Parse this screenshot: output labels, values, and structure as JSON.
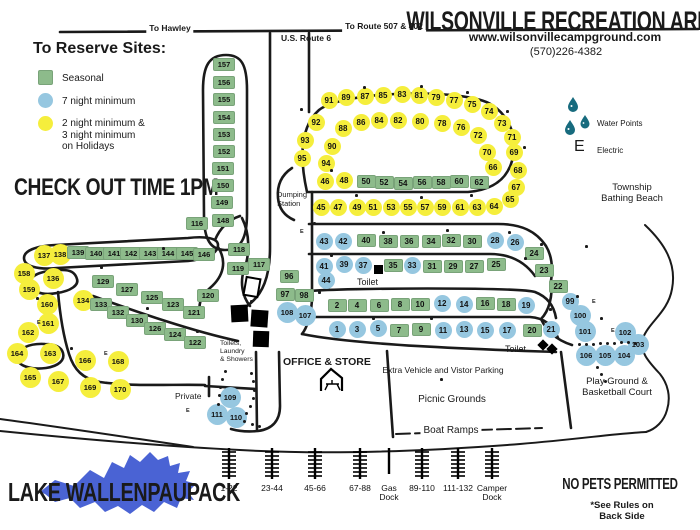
{
  "header": {
    "title": "WILSONVILLE RECREATION AREA",
    "website": "www.wilsonvillecampground.com",
    "phone": "(570)226-4382"
  },
  "legend": {
    "title": "To Reserve Sites:",
    "items": [
      {
        "type": "S",
        "label": "Seasonal"
      },
      {
        "type": "N",
        "label": "7 night minimum"
      },
      {
        "type": "H",
        "label": "2 night minimum &\n3 night minimum\non Holidays"
      }
    ]
  },
  "amenity_legend": {
    "water_label": "Water Points",
    "electric_symbol": "E",
    "electric_label": "Electric"
  },
  "road_labels": {
    "to_hawley": "To Hawley",
    "us_route_6": "U.S. Route 6",
    "to_route_507": "To Route 507 & 402"
  },
  "notes": {
    "checkout": "CHECK OUT TIME 1PM",
    "no_pets": "NO PETS PERMITTED",
    "see_rules": "*See Rules on Back Side",
    "lake_name": "LAKE WALLENPAUPACK"
  },
  "labels": {
    "dumping_station": "Dumping\nStation",
    "toilet_left": "Toilet",
    "toilet_right": "Toilet",
    "office_store": "OFFICE & STORE",
    "toilets_laundry": "Toilets,\nLaundry\n& Showers",
    "private": "Private",
    "township_beach": "Township\nBathing Beach",
    "playground": "Play Ground &\nBasketball Court",
    "extra_parking": "Extra Vehicle and Vistor Parking",
    "picnic_grounds": "Picnic Grounds",
    "boat_ramps": "Boat Ramps"
  },
  "docks": [
    {
      "label": "1-22",
      "x": 229,
      "style": "ladder"
    },
    {
      "label": "23-44",
      "x": 272,
      "style": "ladder"
    },
    {
      "label": "45-66",
      "x": 315,
      "style": "ladder"
    },
    {
      "label": "67-88",
      "x": 360,
      "style": "ladder"
    },
    {
      "label": "Gas\nDock",
      "x": 389,
      "style": "line"
    },
    {
      "label": "89-110",
      "x": 422,
      "style": "ladder"
    },
    {
      "label": "111-132",
      "x": 458,
      "style": "ladder"
    },
    {
      "label": "Camper\nDock",
      "x": 492,
      "style": "ladder"
    }
  ],
  "site_types": {
    "S": "Seasonal",
    "N": "7 night minimum",
    "H": "2 night minimum & 3 night minimum on Holidays"
  },
  "sites_format": "[number, type, x, y]",
  "sites": [
    [
      157,
      "S",
      224,
      64
    ],
    [
      156,
      "S",
      224,
      82
    ],
    [
      155,
      "S",
      224,
      99
    ],
    [
      154,
      "S",
      224,
      117
    ],
    [
      153,
      "S",
      224,
      134
    ],
    [
      152,
      "S",
      224,
      151
    ],
    [
      151,
      "S",
      223,
      168
    ],
    [
      150,
      "S",
      223,
      185
    ],
    [
      149,
      "S",
      222,
      202
    ],
    [
      148,
      "S",
      223,
      220
    ],
    [
      116,
      "S",
      197,
      223
    ],
    [
      118,
      "S",
      239,
      249
    ],
    [
      119,
      "S",
      238,
      268
    ],
    [
      117,
      "S",
      259,
      264
    ],
    [
      96,
      "S",
      289,
      276
    ],
    [
      97,
      "S",
      285,
      294
    ],
    [
      98,
      "S",
      304,
      295
    ],
    [
      108,
      "N",
      287,
      312
    ],
    [
      107,
      "N",
      305,
      315
    ],
    [
      91,
      "H",
      329,
      100
    ],
    [
      89,
      "H",
      346,
      97
    ],
    [
      87,
      "H",
      365,
      96
    ],
    [
      85,
      "H",
      383,
      95
    ],
    [
      83,
      "H",
      402,
      94
    ],
    [
      81,
      "H",
      419,
      95
    ],
    [
      79,
      "H",
      436,
      97
    ],
    [
      77,
      "H",
      454,
      100
    ],
    [
      75,
      "H",
      472,
      104
    ],
    [
      74,
      "H",
      489,
      111
    ],
    [
      73,
      "H",
      502,
      123
    ],
    [
      71,
      "H",
      512,
      137
    ],
    [
      92,
      "H",
      316,
      122
    ],
    [
      88,
      "H",
      343,
      128
    ],
    [
      86,
      "H",
      361,
      122
    ],
    [
      84,
      "H",
      379,
      120
    ],
    [
      82,
      "H",
      398,
      120
    ],
    [
      80,
      "H",
      420,
      121
    ],
    [
      78,
      "H",
      442,
      123
    ],
    [
      76,
      "H",
      461,
      127
    ],
    [
      72,
      "H",
      478,
      135
    ],
    [
      93,
      "H",
      305,
      140
    ],
    [
      90,
      "H",
      332,
      146
    ],
    [
      70,
      "H",
      487,
      152
    ],
    [
      69,
      "H",
      514,
      152
    ],
    [
      95,
      "H",
      302,
      158
    ],
    [
      94,
      "H",
      326,
      163
    ],
    [
      66,
      "H",
      493,
      167
    ],
    [
      68,
      "H",
      518,
      170
    ],
    [
      67,
      "H",
      516,
      187
    ],
    [
      65,
      "H",
      510,
      199
    ],
    [
      46,
      "H",
      325,
      181
    ],
    [
      48,
      "H",
      344,
      180
    ],
    [
      50,
      "S",
      366,
      181
    ],
    [
      52,
      "S",
      384,
      182
    ],
    [
      54,
      "S",
      403,
      183
    ],
    [
      56,
      "S",
      422,
      182
    ],
    [
      58,
      "S",
      441,
      182
    ],
    [
      60,
      "S",
      459,
      181
    ],
    [
      62,
      "S",
      479,
      182
    ],
    [
      45,
      "H",
      321,
      207
    ],
    [
      47,
      "H",
      338,
      207
    ],
    [
      49,
      "H",
      357,
      207
    ],
    [
      51,
      "H",
      373,
      207
    ],
    [
      53,
      "H",
      391,
      207
    ],
    [
      55,
      "H",
      408,
      207
    ],
    [
      57,
      "H",
      425,
      207
    ],
    [
      59,
      "H",
      442,
      207
    ],
    [
      61,
      "H",
      460,
      207
    ],
    [
      63,
      "H",
      477,
      207
    ],
    [
      64,
      "H",
      494,
      206
    ],
    [
      43,
      "N",
      324,
      241
    ],
    [
      42,
      "N",
      343,
      241
    ],
    [
      40,
      "S",
      366,
      240
    ],
    [
      38,
      "S",
      388,
      241
    ],
    [
      36,
      "S",
      409,
      241
    ],
    [
      34,
      "S",
      431,
      241
    ],
    [
      32,
      "S",
      451,
      240
    ],
    [
      30,
      "S",
      472,
      241
    ],
    [
      28,
      "N",
      495,
      240
    ],
    [
      26,
      "N",
      515,
      242
    ],
    [
      24,
      "S",
      534,
      253
    ],
    [
      23,
      "S",
      544,
      270
    ],
    [
      41,
      "N",
      324,
      266
    ],
    [
      39,
      "N",
      344,
      264
    ],
    [
      37,
      "N",
      363,
      265
    ],
    [
      35,
      "S",
      393,
      265
    ],
    [
      33,
      "N",
      412,
      265
    ],
    [
      31,
      "S",
      432,
      266
    ],
    [
      29,
      "S",
      453,
      266
    ],
    [
      27,
      "S",
      474,
      266
    ],
    [
      25,
      "S",
      496,
      264
    ],
    [
      44,
      "N",
      326,
      280
    ],
    [
      2,
      "S",
      337,
      305
    ],
    [
      4,
      "S",
      357,
      305
    ],
    [
      6,
      "S",
      379,
      305
    ],
    [
      8,
      "S",
      400,
      304
    ],
    [
      10,
      "S",
      420,
      304
    ],
    [
      12,
      "N",
      442,
      303
    ],
    [
      14,
      "N",
      464,
      304
    ],
    [
      16,
      "S",
      485,
      303
    ],
    [
      18,
      "S",
      506,
      304
    ],
    [
      19,
      "N",
      526,
      305
    ],
    [
      1,
      "N",
      337,
      329
    ],
    [
      3,
      "N",
      357,
      329
    ],
    [
      5,
      "N",
      378,
      328
    ],
    [
      7,
      "S",
      399,
      330
    ],
    [
      9,
      "S",
      421,
      329
    ],
    [
      11,
      "N",
      443,
      330
    ],
    [
      13,
      "N",
      464,
      329
    ],
    [
      15,
      "N",
      485,
      330
    ],
    [
      17,
      "N",
      507,
      330
    ],
    [
      20,
      "S",
      532,
      330
    ],
    [
      21,
      "N",
      551,
      329
    ],
    [
      22,
      "S",
      558,
      286
    ],
    [
      99,
      "N",
      570,
      301
    ],
    [
      100,
      "N",
      580,
      315
    ],
    [
      101,
      "N",
      585,
      331
    ],
    [
      102,
      "N",
      625,
      332
    ],
    [
      103,
      "N",
      638,
      344
    ],
    [
      104,
      "N",
      624,
      355
    ],
    [
      105,
      "N",
      605,
      355
    ],
    [
      106,
      "N",
      586,
      355
    ],
    [
      137,
      "H",
      44,
      255
    ],
    [
      138,
      "H",
      60,
      254
    ],
    [
      139,
      "S",
      78,
      252
    ],
    [
      140,
      "S",
      96,
      253
    ],
    [
      141,
      "S",
      114,
      253
    ],
    [
      142,
      "S",
      131,
      253
    ],
    [
      143,
      "S",
      150,
      253
    ],
    [
      144,
      "S",
      168,
      253
    ],
    [
      145,
      "S",
      187,
      253
    ],
    [
      146,
      "S",
      204,
      254
    ],
    [
      158,
      "H",
      24,
      273
    ],
    [
      136,
      "H",
      53,
      278
    ],
    [
      159,
      "H",
      29,
      289
    ],
    [
      129,
      "S",
      103,
      281
    ],
    [
      127,
      "S",
      127,
      289
    ],
    [
      125,
      "S",
      152,
      297
    ],
    [
      123,
      "S",
      173,
      304
    ],
    [
      121,
      "S",
      194,
      312
    ],
    [
      120,
      "S",
      208,
      295
    ],
    [
      134,
      "H",
      83,
      300
    ],
    [
      133,
      "S",
      101,
      304
    ],
    [
      132,
      "S",
      118,
      312
    ],
    [
      130,
      "S",
      137,
      320
    ],
    [
      126,
      "S",
      155,
      328
    ],
    [
      124,
      "S",
      175,
      334
    ],
    [
      122,
      "S",
      195,
      342
    ],
    [
      160,
      "H",
      47,
      304
    ],
    [
      161,
      "H",
      48,
      323
    ],
    [
      162,
      "H",
      28,
      332
    ],
    [
      164,
      "H",
      17,
      353
    ],
    [
      163,
      "H",
      50,
      353
    ],
    [
      166,
      "H",
      85,
      360
    ],
    [
      168,
      "H",
      118,
      361
    ],
    [
      165,
      "H",
      30,
      377
    ],
    [
      167,
      "H",
      58,
      381
    ],
    [
      169,
      "H",
      90,
      387
    ],
    [
      170,
      "H",
      120,
      389
    ],
    [
      109,
      "N",
      230,
      397
    ],
    [
      111,
      "N",
      217,
      414
    ],
    [
      110,
      "N",
      236,
      417
    ]
  ],
  "decor": {
    "water_dots": [
      [
        300,
        108
      ],
      [
        363,
        86
      ],
      [
        420,
        85
      ],
      [
        466,
        91
      ],
      [
        506,
        110
      ],
      [
        523,
        146
      ],
      [
        330,
        169
      ],
      [
        355,
        194
      ],
      [
        420,
        196
      ],
      [
        470,
        194
      ],
      [
        313,
        222
      ],
      [
        382,
        231
      ],
      [
        446,
        229
      ],
      [
        508,
        231
      ],
      [
        540,
        243
      ],
      [
        318,
        291
      ],
      [
        372,
        317
      ],
      [
        430,
        317
      ],
      [
        576,
        295
      ],
      [
        600,
        317
      ],
      [
        162,
        247
      ],
      [
        100,
        266
      ],
      [
        36,
        297
      ],
      [
        70,
        347
      ],
      [
        146,
        307
      ],
      [
        196,
        330
      ],
      [
        250,
        300
      ],
      [
        330,
        254
      ],
      [
        524,
        257
      ],
      [
        549,
        308
      ],
      [
        440,
        378
      ],
      [
        585,
        245
      ]
    ],
    "trail_dots": [
      [
        224,
        370
      ],
      [
        221,
        378
      ],
      [
        219,
        386
      ],
      [
        218,
        394
      ],
      [
        217,
        403
      ],
      [
        250,
        372
      ],
      [
        252,
        380
      ],
      [
        253,
        389
      ],
      [
        252,
        397
      ],
      [
        249,
        405
      ],
      [
        245,
        412
      ],
      [
        243,
        420
      ],
      [
        251,
        423
      ],
      [
        258,
        425
      ],
      [
        578,
        343
      ],
      [
        585,
        343
      ],
      [
        592,
        343
      ],
      [
        599,
        342
      ],
      [
        606,
        342
      ],
      [
        613,
        342
      ],
      [
        620,
        341
      ],
      [
        627,
        341
      ],
      [
        634,
        342
      ],
      [
        596,
        366
      ],
      [
        600,
        373
      ],
      [
        604,
        380
      ]
    ],
    "e_marks": [
      [
        592,
        299
      ],
      [
        611,
        328
      ],
      [
        37,
        320
      ],
      [
        104,
        351
      ],
      [
        186,
        408
      ],
      [
        300,
        229
      ]
    ]
  },
  "colors": {
    "seasonal": "#8dbb8b",
    "seven_night": "#96c7e0",
    "two_night": "#f5ee3c",
    "water_drop": "#176b7e",
    "lake": "#4a63d4",
    "road": "#1a1a1a"
  }
}
